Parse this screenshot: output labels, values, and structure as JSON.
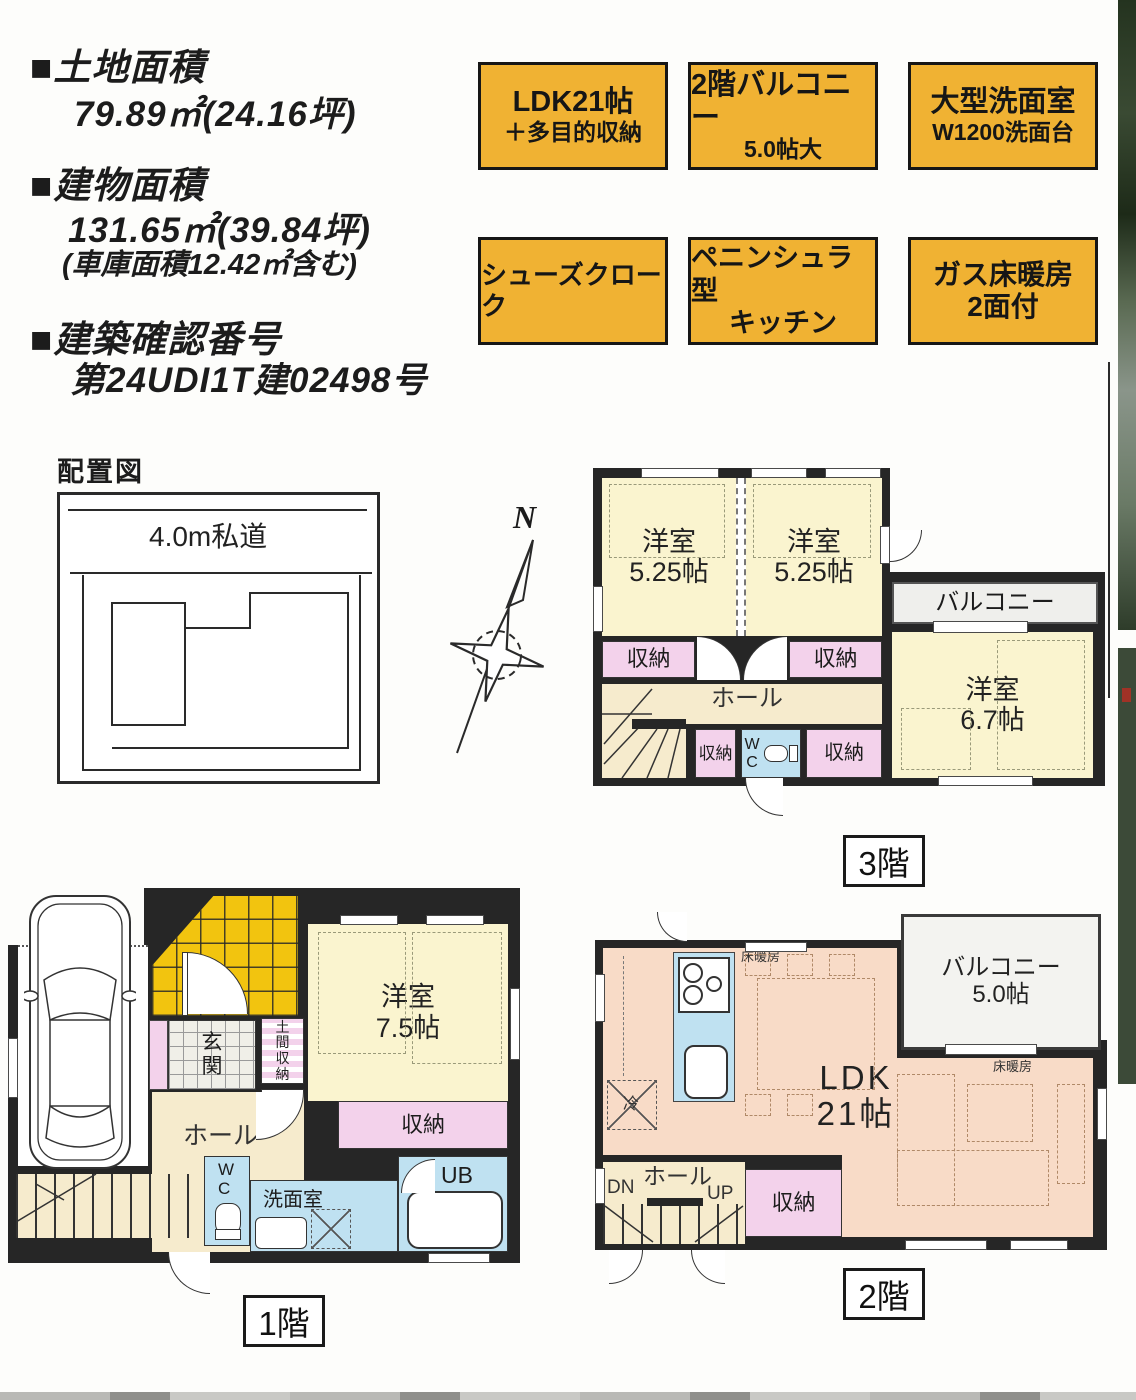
{
  "info": {
    "land_heading": "■土地面積",
    "land_value": "79.89㎡(24.16坪)",
    "bldg_heading": "■建物面積",
    "bldg_value": "131.65㎡(39.84坪)",
    "bldg_note": "(車庫面積12.42㎡含む)",
    "conf_heading": "■建築確認番号",
    "conf_value": "第24UDI1T建02498号"
  },
  "badges": [
    {
      "line1": "LDK21帖",
      "line2": "＋多目的収納"
    },
    {
      "line1": "2階バルコニー",
      "line2": "5.0帖大"
    },
    {
      "line1": "大型洗面室",
      "line2": "W1200洗面台"
    },
    {
      "line1": "シューズクローク",
      "line2": ""
    },
    {
      "line1": "ペニンシュラ型",
      "line2": "キッチン"
    },
    {
      "line1": "ガス床暖房",
      "line2": "2面付"
    }
  ],
  "site": {
    "title": "配置図",
    "road": "4.0m私道"
  },
  "compass": {
    "n": "N"
  },
  "f3": {
    "tag": "3階",
    "bed1": "洋室\n5.25帖",
    "bed2": "洋室\n5.25帖",
    "bed3": "洋室\n6.7帖",
    "balcony": "バルコニー",
    "storage": "収納",
    "dn": "DN",
    "hall": "ホール",
    "wc": "W\nC"
  },
  "f1": {
    "tag": "1階",
    "genkan": "玄\n関",
    "doma": "土\n間\n収\n納",
    "storage_s": "収納",
    "hall": "ホール",
    "up": "UP",
    "wc": "W\nC",
    "senmen": "洗面室",
    "ub": "UB",
    "bed": "洋室\n7.5帖",
    "storage": "収納"
  },
  "f2": {
    "tag": "2階",
    "ldk": "LDK\n21帖",
    "balcony": "バルコニー\n5.0帖",
    "heat": "床暖房",
    "fridge": "冷",
    "hall": "ホール",
    "dn": "DN",
    "up": "UP",
    "storage": "収納"
  }
}
